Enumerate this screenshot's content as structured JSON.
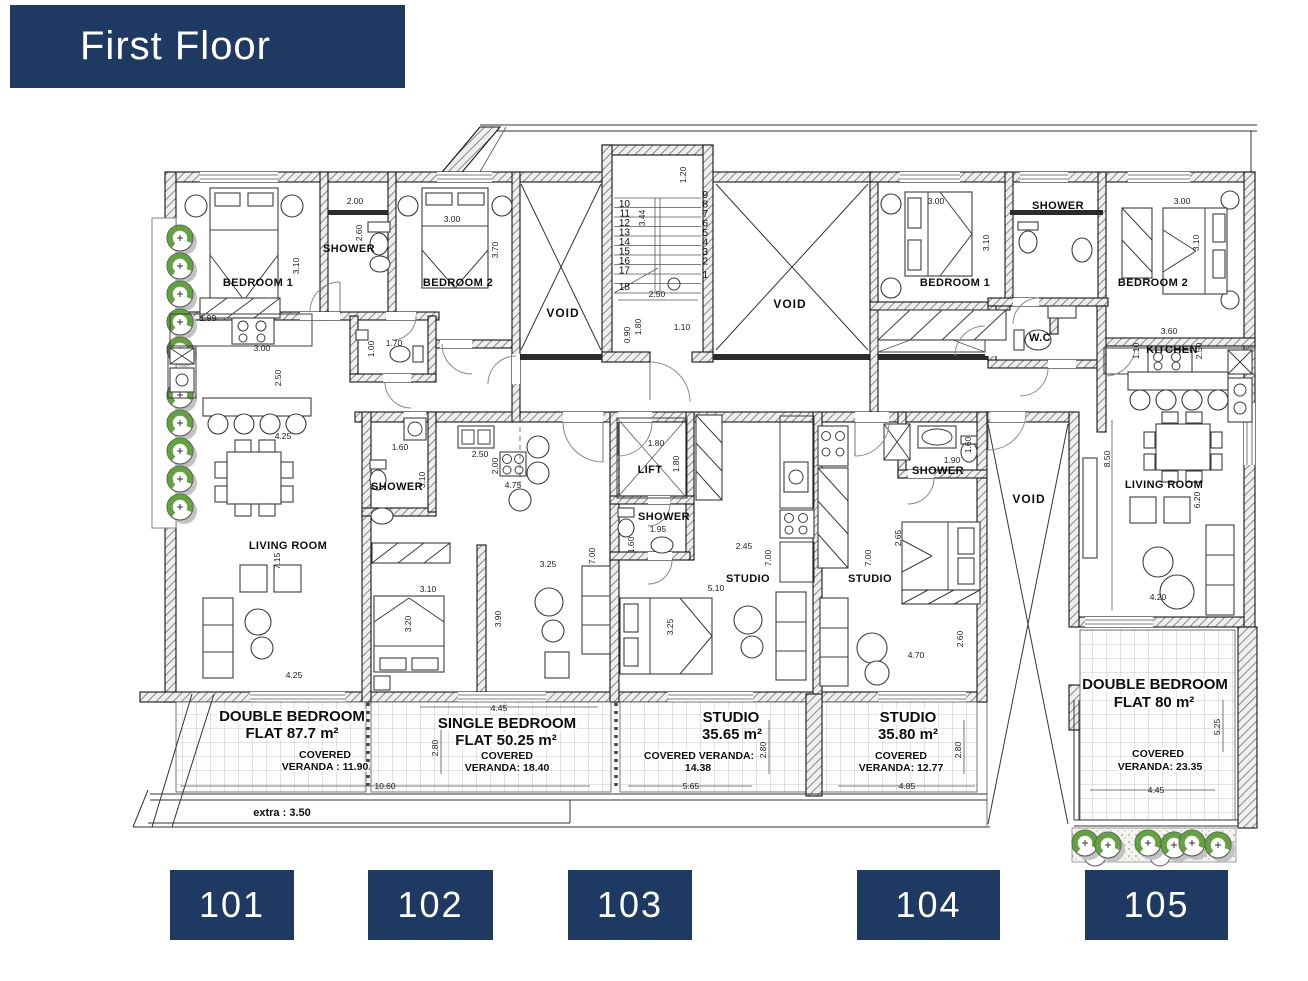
{
  "header": {
    "title": "First Floor",
    "bg": "#1e3a63",
    "fg": "#ffffff"
  },
  "flats": [
    {
      "unit": "101",
      "label_line1": "DOUBLE BEDROOM",
      "label_line2": "FLAT 87.7 m²",
      "veranda_line1": "COVERED",
      "veranda_line2": "VERANDA : 11.90"
    },
    {
      "unit": "102",
      "label_line1": "SINGLE BEDROOM",
      "label_line2": "FLAT 50.25 m²",
      "veranda_line1": "COVERED",
      "veranda_line2": "VERANDA: 18.40"
    },
    {
      "unit": "103",
      "label_line1": "STUDIO",
      "label_line2": "35.65 m²",
      "veranda_line1": "COVERED VERANDA:",
      "veranda_line2": "14.38"
    },
    {
      "unit": "104",
      "label_line1": "STUDIO",
      "label_line2": "35.80 m²",
      "veranda_line1": "COVERED",
      "veranda_line2": "VERANDA: 12.77"
    },
    {
      "unit": "105",
      "label_line1": "DOUBLE BEDROOM",
      "label_line2": "FLAT 80 m²",
      "veranda_line1": "COVERED",
      "veranda_line2": "VERANDA: 23.35"
    }
  ],
  "plan": {
    "rooms": {
      "bed1_101": "BEDROOM 1",
      "shower_101": "SHOWER",
      "bed2_101": "BEDROOM 2",
      "living_101": "LIVING ROOM",
      "void": "VOID",
      "shower_102": "SHOWER",
      "lift": "LIFT",
      "shower_103": "SHOWER",
      "studio_103": "STUDIO",
      "studio_104": "STUDIO",
      "shower_104": "SHOWER",
      "bed1_105": "BEDROOM 1",
      "shower_105": "SHOWER",
      "wc_105": "W.C",
      "bed2_105": "BEDROOM 2",
      "kitchen_105": "KITCHEN",
      "living_105": "LIVING ROOM"
    },
    "stairs": {
      "left": [
        "10",
        "11",
        "12",
        "13",
        "14",
        "15",
        "16",
        "17",
        "18"
      ],
      "right": [
        "9",
        "8",
        "7",
        "6",
        "5",
        "4",
        "3",
        "2",
        "1"
      ]
    },
    "dims": [
      "2.00",
      "2.60",
      "3.10",
      "3.00",
      "3.70",
      "1.99",
      "1.70",
      "1.00",
      "3.00",
      "2.50",
      "4.25",
      "7.15",
      "4.25",
      "1.20",
      "3.44",
      "2.50",
      "0.90",
      "1.80",
      "1.10",
      "1.60",
      "3.10",
      "2.50",
      "2.00",
      "4.75",
      "3.25",
      "7.00",
      "3.10",
      "3.90",
      "3.20",
      "1.80",
      "1.80",
      "1.95",
      "1.60",
      "2.45",
      "7.00",
      "5.10",
      "3.25",
      "1.60",
      "1.90",
      "2.65",
      "7.00",
      "2.60",
      "4.70",
      "3.00",
      "3.10",
      "3.00",
      "3.10",
      "3.60",
      "1.10",
      "2.50",
      "8.50",
      "6.20",
      "4.20",
      "4.45",
      "2.80",
      "10.60",
      "2.80",
      "5.65",
      "2.80",
      "4.85",
      "5.25",
      "4.45"
    ],
    "extra_note": "extra : 3.50"
  }
}
